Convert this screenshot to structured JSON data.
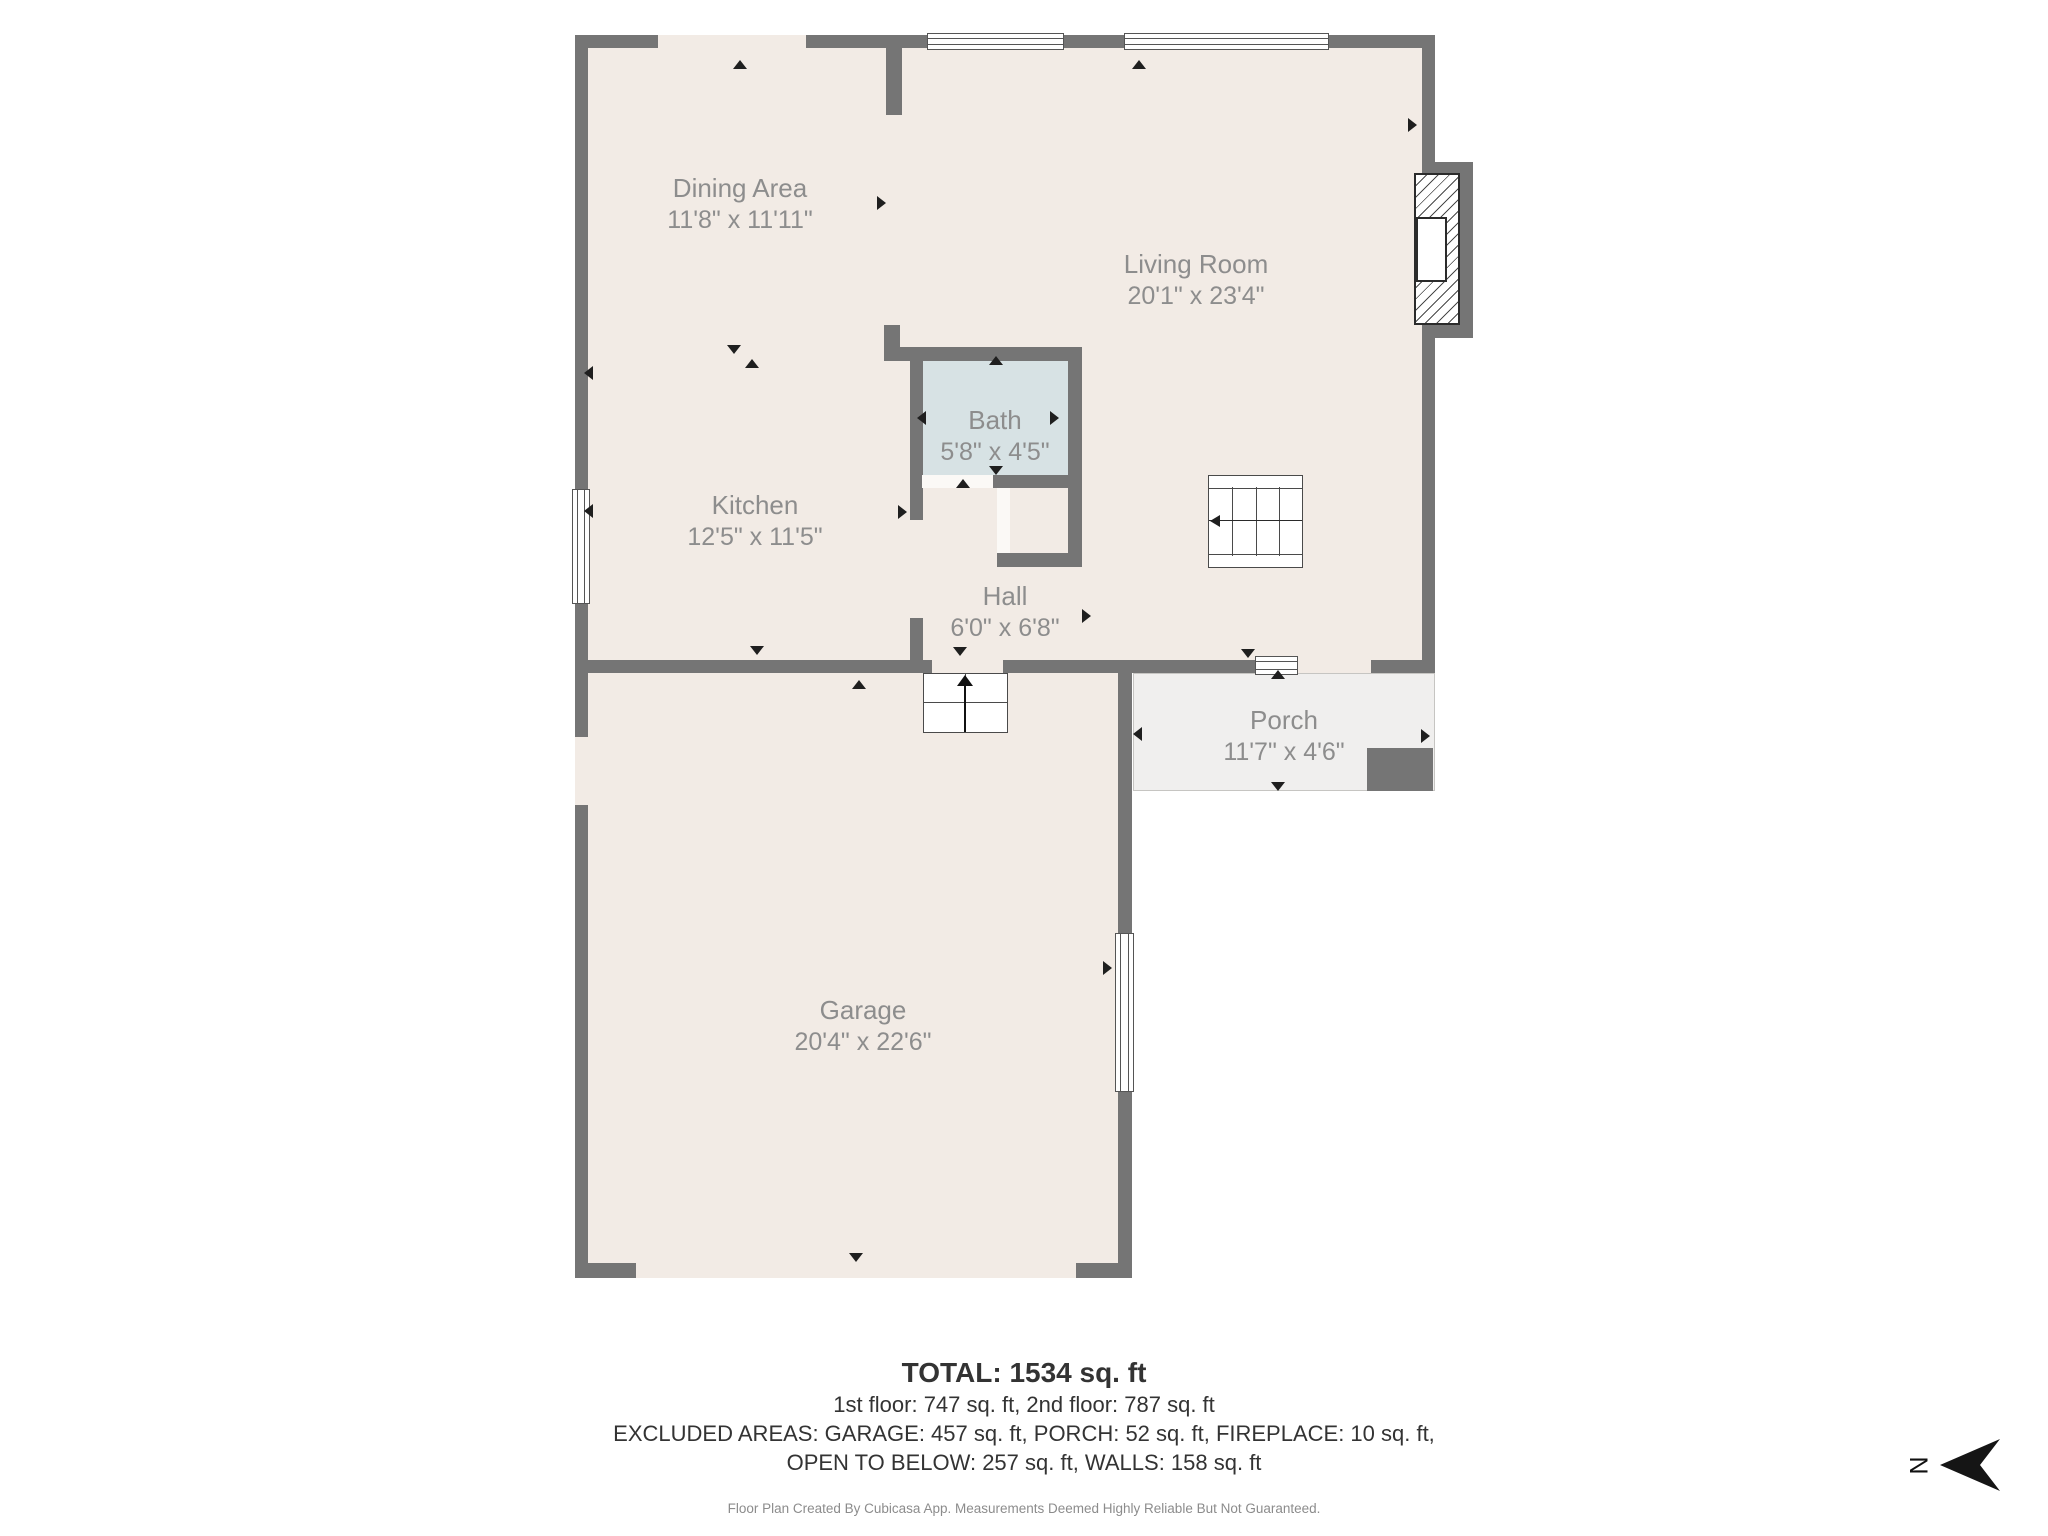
{
  "rooms": [
    {
      "name": "Dining Area",
      "dims": "11'8\" x 11'11\""
    },
    {
      "name": "Living Room",
      "dims": "20'1\" x 23'4\""
    },
    {
      "name": "Kitchen",
      "dims": "12'5\" x 11'5\""
    },
    {
      "name": "Bath",
      "dims": "5'8\" x 4'5\""
    },
    {
      "name": "Hall",
      "dims": "6'0\" x 6'8\""
    },
    {
      "name": "Porch",
      "dims": "11'7\" x 4'6\""
    },
    {
      "name": "Garage",
      "dims": "20'4\" x 22'6\""
    }
  ],
  "summary": {
    "total": "TOTAL: 1534 sq. ft",
    "floors": "1st floor: 747 sq. ft, 2nd floor: 787 sq. ft",
    "excluded1": "EXCLUDED AREAS: GARAGE: 457 sq. ft, PORCH: 52 sq. ft, FIREPLACE: 10 sq. ft,",
    "excluded2": "OPEN TO BELOW: 257 sq. ft, WALLS: 158 sq. ft",
    "disclaimer": "Floor Plan Created By Cubicasa App. Measurements Deemed Highly Reliable But Not Guaranteed."
  },
  "compass": {
    "north_label": "N"
  },
  "colors": {
    "wall": "#757575",
    "floor": "#f2ebe5",
    "bath_floor": "#d7e2e4",
    "porch_floor": "#f0efee",
    "room_label_text": "#8d8d8d",
    "summary_text": "#333333",
    "disclaimer_text": "#8c8c8c"
  }
}
